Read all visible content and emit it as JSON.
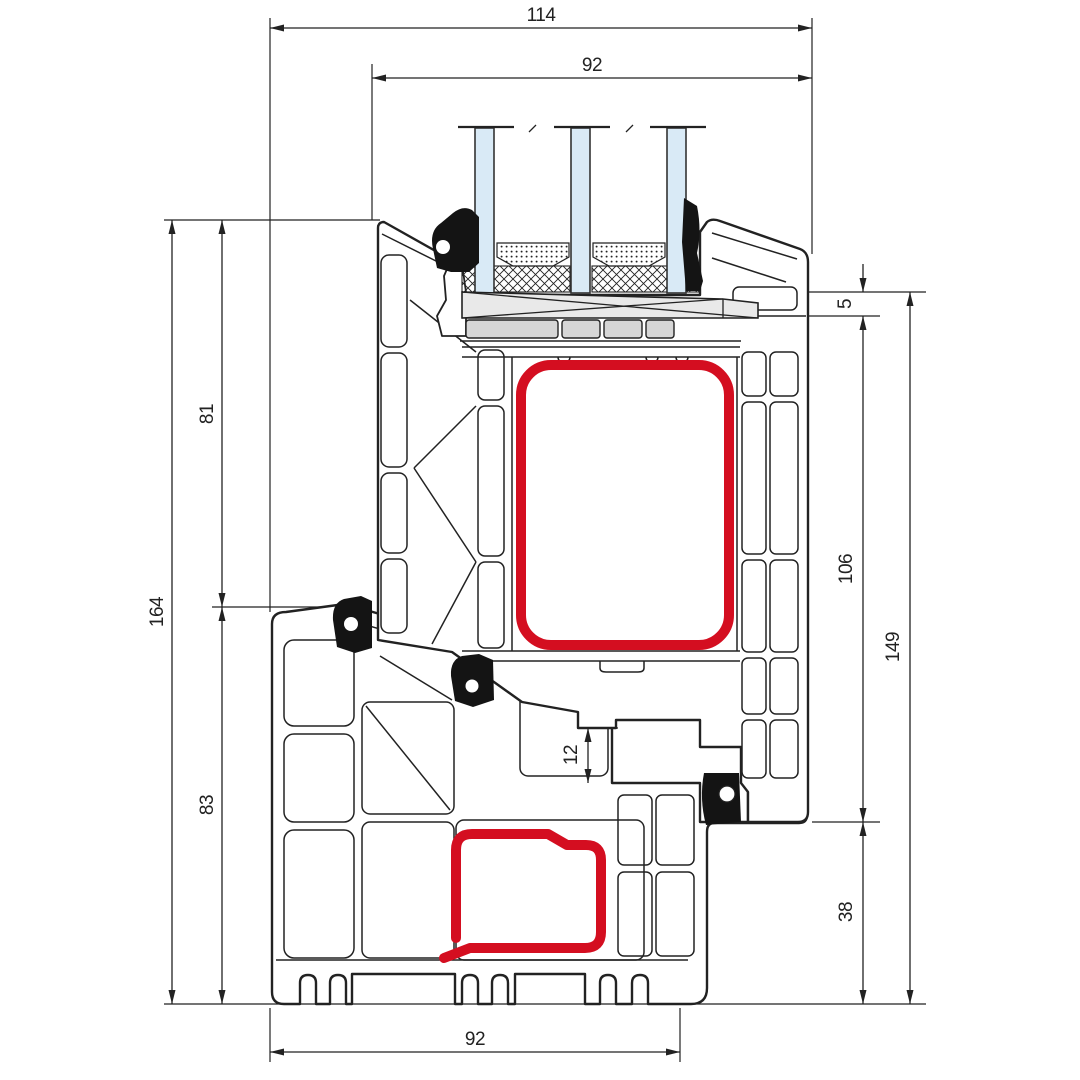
{
  "drawing": {
    "title": "Window profile cross-section",
    "type": "technical-drawing",
    "dimensions": {
      "overall_width": "114",
      "sash_width": "92",
      "overall_height_left": "164",
      "upper_height": "81",
      "lower_height": "83",
      "glass_edge_step": "5",
      "sash_side_height": "106",
      "overall_height_right": "149",
      "frame_lower_height": "38",
      "rebate_gap": "12",
      "frame_width": "92"
    },
    "colors": {
      "line": "#222222",
      "reinforcement_red": "#d40e20",
      "glass_blue": "#d9eaf6",
      "block_gray": "#d6d6d6",
      "bridge_gray": "#e9e9e9",
      "gasket_black": "#141414",
      "background": "#ffffff"
    },
    "components": {
      "glazing": "triple-glazing-unit",
      "upper_reinforcement": "sash-steel-reinforcement",
      "lower_reinforcement": "frame-steel-reinforcement"
    }
  }
}
